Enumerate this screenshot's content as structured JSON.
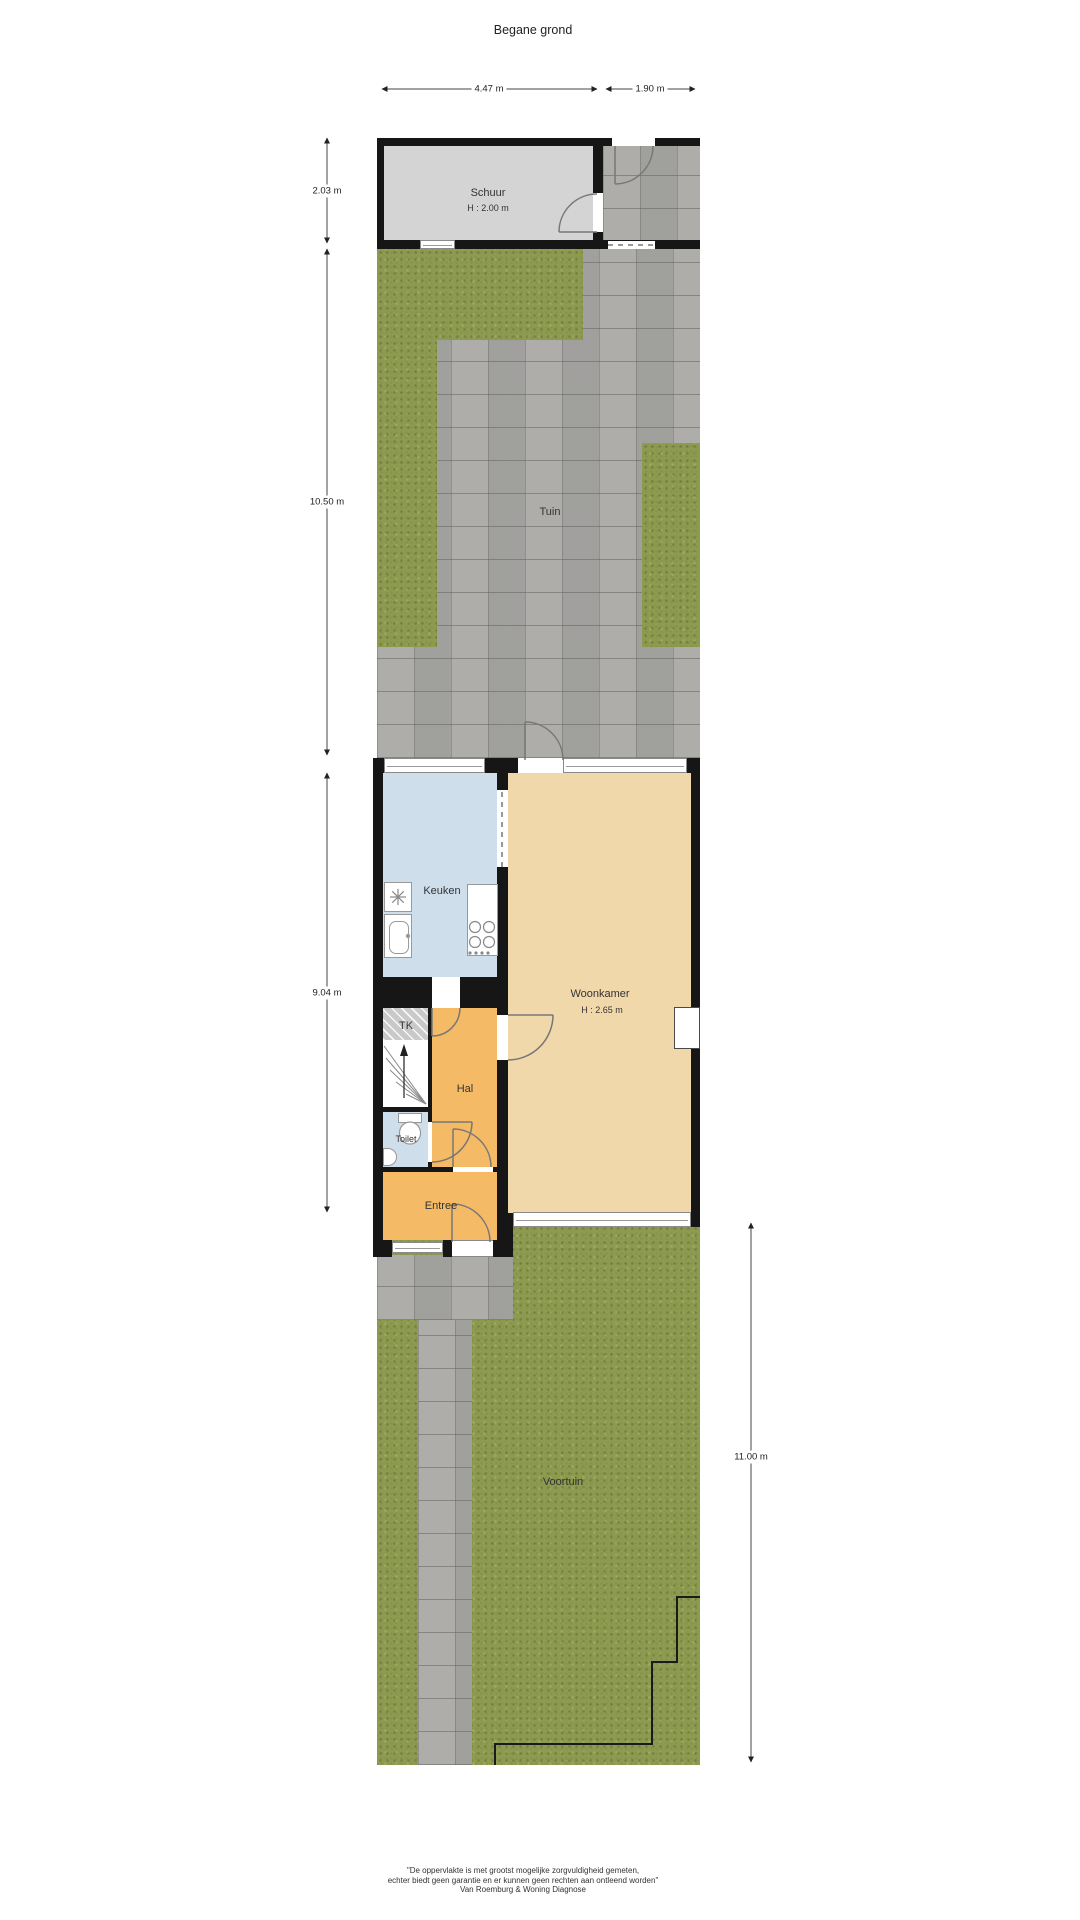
{
  "title": "Begane grond",
  "dims": {
    "schuur_width": "4.47 m",
    "side_width": "1.90 m",
    "schuur_depth": "2.03 m",
    "tuin_depth": "10.50 m",
    "house_depth": "9.04 m",
    "voortuin_depth": "11.00 m"
  },
  "rooms": {
    "schuur": "Schuur",
    "schuur_height": "H : 2.00 m",
    "tuin": "Tuin",
    "keuken": "Keuken",
    "woonkamer": "Woonkamer",
    "woonkamer_height": "H : 2.65 m",
    "tk": "TK",
    "hal": "Hal",
    "toilet": "Toilet",
    "entree": "Entree",
    "voortuin": "Voortuin"
  },
  "footer": {
    "line1": "\"De oppervlakte is met grootst mogelijke zorgvuldigheid gemeten,",
    "line2": "echter biedt geen garantie en er kunnen geen rechten aan ontleend worden\"",
    "line3": "Van Roemburg & Woning Diagnose"
  },
  "colors": {
    "wall": "#161616",
    "grass": "#8d9b51",
    "paving": "#a9a8a5",
    "schuur": "#d4d4d4",
    "keuken": "#cfdeeb",
    "woon": "#f1d8ab",
    "hal": "#f4ba66"
  }
}
